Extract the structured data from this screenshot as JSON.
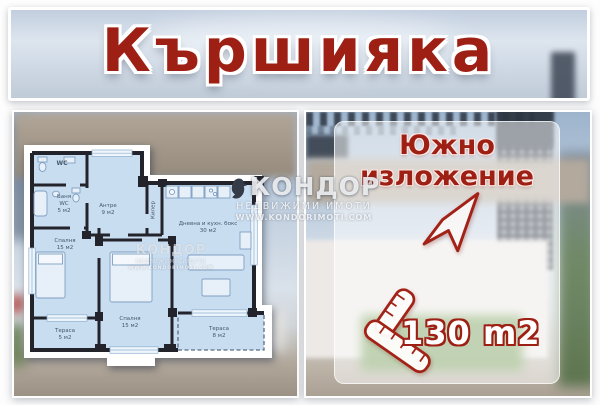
{
  "title": "Кършияка",
  "watermark": {
    "brand": "КОНДОР",
    "tagline": "НЕДВИЖИМИ ИМОТИ",
    "website": "WWW.KONDORIMOTI.COM"
  },
  "floor_plan": {
    "rooms": [
      {
        "lines": [
          "WC"
        ]
      },
      {
        "lines": [
          "Баня",
          "WC",
          "5 м2"
        ]
      },
      {
        "lines": [
          "Антре",
          "9 м2"
        ]
      },
      {
        "lines": [
          "Килер"
        ]
      },
      {
        "lines": [
          "Дневна и кухн. бокс",
          "30 м2"
        ]
      },
      {
        "lines": [
          "Спалня",
          "15 м2"
        ]
      },
      {
        "lines": [
          "Спалня",
          "15 м2"
        ]
      },
      {
        "lines": [
          "Тераса",
          "5 м2"
        ]
      },
      {
        "lines": [
          "Тераса",
          "8 м2"
        ]
      }
    ]
  },
  "right_panel": {
    "exposure_line1": "Южно",
    "exposure_line2": "изложение",
    "area": "130 m2"
  },
  "icons": {
    "arrow": "arrow-northeast",
    "ruler": "ruler-square",
    "logo": "condor-bird"
  },
  "colors": {
    "accent_red": "#9e2015",
    "plan_fill": "#c9ddf0",
    "wall": "#23232b",
    "label_blue": "#44566b"
  }
}
